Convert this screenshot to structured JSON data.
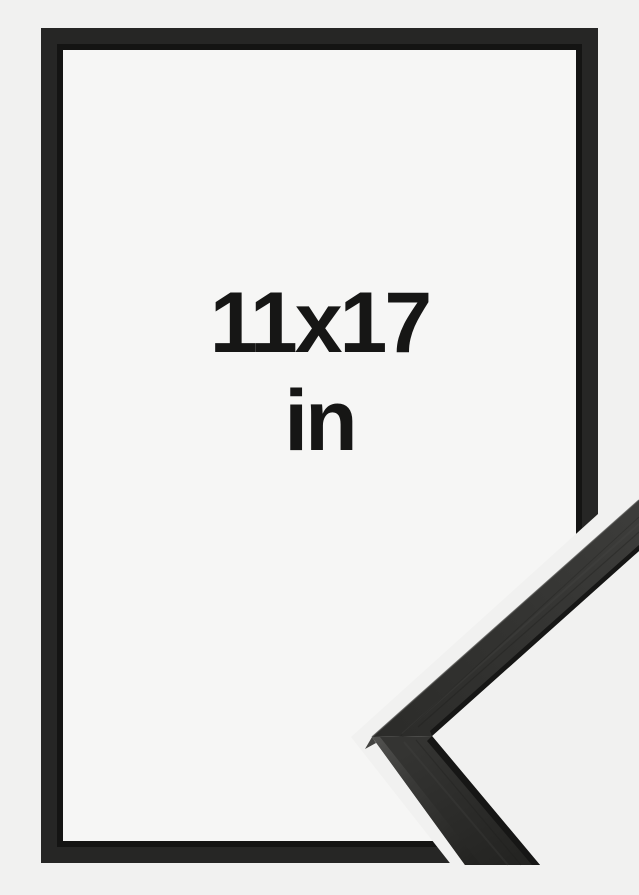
{
  "image": {
    "type": "product-photo",
    "subject": "black wooden picture frame shown empty with a magnified corner profile sample over the lower-right corner",
    "size_label": "11x17",
    "unit_label": "in"
  },
  "colors": {
    "background": "#f1f1f0",
    "frame_interior": "#f6f6f5",
    "frame_moulding": "#262625",
    "frame_inner_lip": "#141413",
    "sample_face_light": "#3d3d3b",
    "sample_face_dark": "#292927",
    "sample_inner_edge": "#161615",
    "sample_side_highlight": "#4c4c4a",
    "label_text": "#161615"
  }
}
